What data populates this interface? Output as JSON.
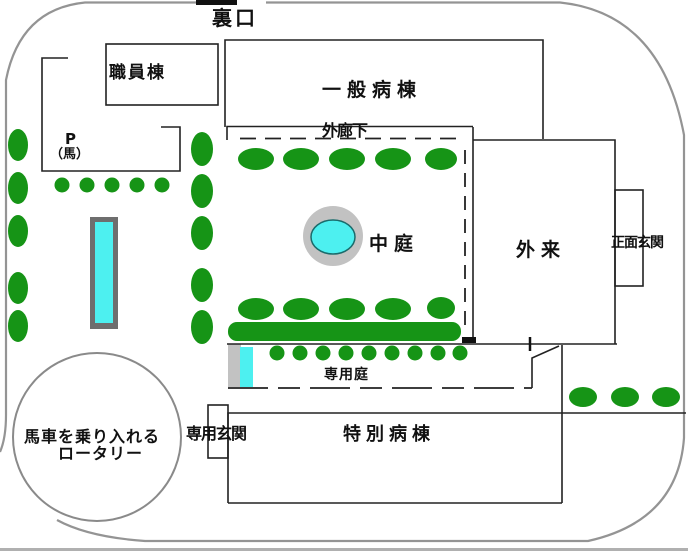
{
  "labels": {
    "back_gate": "裏口",
    "staff_building": "職員棟",
    "general_ward": "一般病棟",
    "outer_corridor": "外廊下",
    "parking_p": "P",
    "parking_horse": "（馬）",
    "courtyard": "中庭",
    "outpatient": "外来",
    "main_entrance": "正面玄関",
    "private_garden": "専用庭",
    "private_entrance": "専用玄関",
    "special_ward": "特別病棟",
    "rotary_line1": "馬車を乗り入れる",
    "rotary_line2": "ロータリー"
  },
  "colors": {
    "tree_green": "#169416",
    "hedge_green": "#169416",
    "water_cyan": "#4df0f0",
    "pond_ring_gray": "#c2c2c2",
    "pond_stroke": "#1a6b6b",
    "pool_border_gray": "#6e6e6e",
    "boundary_gray": "#949494",
    "building_line": "#222222",
    "gate_black": "#111111"
  }
}
